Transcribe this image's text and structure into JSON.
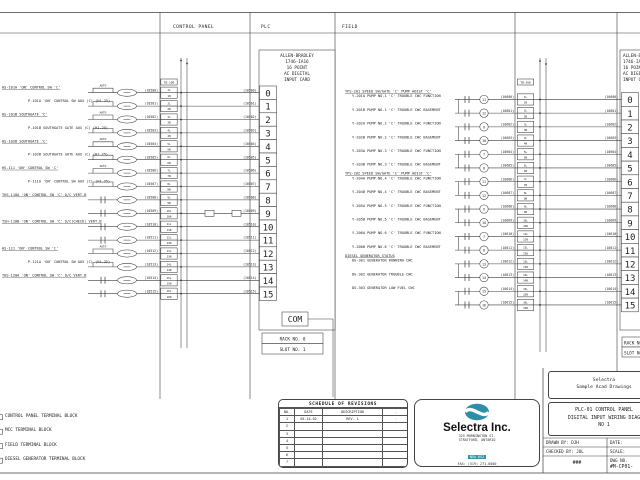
{
  "headers": {
    "control_panel": "CONTROL PANEL",
    "plc": "PLC",
    "field": "FIELD"
  },
  "left_card": {
    "title_lines": [
      "ALLEN-BRADLEY",
      "1746-IA16",
      "16 POINT",
      "AC DIGITAL",
      "INPUT CARD"
    ],
    "points": [
      "0",
      "1",
      "2",
      "3",
      "4",
      "5",
      "6",
      "7",
      "8",
      "9",
      "10",
      "11",
      "12",
      "13",
      "14",
      "15"
    ],
    "com": "COM",
    "rack": "RACK NO. 0",
    "slot": "SLOT NO. 1",
    "tb": "TB-100"
  },
  "right_card": {
    "title_lines": [
      "ALLEN-BRADLEY",
      "1746-IA16",
      "16 POINT",
      "AC DIGITAL",
      "INPUT CARD"
    ],
    "points": [
      "0",
      "1",
      "2",
      "3",
      "4",
      "5",
      "6",
      "7",
      "8",
      "9",
      "10",
      "11",
      "12",
      "13",
      "14",
      "15"
    ],
    "rack": "RACK NO. 0",
    "slot": "SLOT NO. 2",
    "tb": "TB-300"
  },
  "left_rows": [
    {
      "label": "HS-101A 'ON' CONTROL SW 'C'",
      "type": "main",
      "sym": "bracket",
      "auto": true,
      "wire": "10500",
      "tl": "1L",
      "tn": "1N"
    },
    {
      "label": "P-101A 'ON' CONTROL SW AUX (C) (H1.25)",
      "type": "sub",
      "sym": "bracket",
      "auto": false,
      "wire": "10501",
      "tl": "2L",
      "tn": "2N"
    },
    {
      "label": "HS-101B SOUTHGATE 'C'",
      "type": "main",
      "sym": "bracket",
      "auto": true,
      "wire": "10502",
      "tl": "3L",
      "tn": "3N"
    },
    {
      "label": "P-101B SOUTHGATE GATE AUX (C) (H1.25)",
      "type": "sub",
      "sym": "bracket",
      "auto": false,
      "wire": "10503",
      "tl": "4L",
      "tn": "4N"
    },
    {
      "label": "HS-102B SOUTHGATE 'C'",
      "type": "main",
      "sym": "bracket",
      "auto": true,
      "wire": "10504",
      "tl": "5L",
      "tn": "5N"
    },
    {
      "label": "P-102B SOUTHGATE GATE AUX (C) (H1.25)",
      "type": "sub",
      "sym": "bracket",
      "auto": false,
      "wire": "10505",
      "tl": "6L",
      "tn": "6N"
    },
    {
      "label": "HS-111 'ON' CONTROL SW 'C'",
      "type": "main",
      "sym": "bracket",
      "auto": true,
      "wire": "10506",
      "tl": "7L",
      "tn": "7N"
    },
    {
      "label": "P-111A 'ON' CONTROL SW AUX (C) (H1.25)",
      "type": "sub",
      "sym": "bracket",
      "auto": false,
      "wire": "10507",
      "tl": "8L",
      "tn": "8N"
    },
    {
      "label": "THS-110A 'ON' CONTROL SW 'C' O/C VERT.B",
      "type": "main",
      "sym": "contact",
      "auto": false,
      "wire": "10508",
      "tl": "9L",
      "tn": "9N"
    },
    {
      "label": "",
      "type": "sub",
      "sym": "contact",
      "auto": false,
      "wire": "10509",
      "tl": "10L",
      "tn": "10N"
    },
    {
      "label": "TSH-110B 'ON' CONTROL SW 'C' O/C(CHECK) VERT.B",
      "type": "main",
      "sym": "contact",
      "auto": false,
      "wire": "10510",
      "tl": "11L",
      "tn": "11N"
    },
    {
      "label": "",
      "type": "sub",
      "sym": "contact",
      "auto": false,
      "wire": "10511",
      "tl": "12L",
      "tn": "12N"
    },
    {
      "label": "HS-121 'ON' CONTROL SW 'C'",
      "type": "main",
      "sym": "bracket",
      "auto": true,
      "wire": "10512",
      "tl": "13L",
      "tn": "13N"
    },
    {
      "label": "P-121A 'ON' CONTROL SW AUX (C) (H1.25)",
      "type": "sub",
      "sym": "bracket",
      "auto": false,
      "wire": "10513",
      "tl": "14L",
      "tn": "14N"
    },
    {
      "label": "THS-120A 'ON' CONTROL SW 'C' O/C VERT.B",
      "type": "main",
      "sym": "contact",
      "auto": false,
      "wire": "10514",
      "tl": "15L",
      "tn": "15N"
    },
    {
      "label": "",
      "type": "sub",
      "sym": "contact",
      "auto": false,
      "wire": "10515",
      "tl": "16L",
      "tn": "16N"
    }
  ],
  "right_rows": [
    {
      "heading": "YPS-201 SPEED SW/GATE 'C' PUMP HOIST 'C'",
      "label": "Y-201A PUMP NO.1 'C' TROUBLE CWC FUNCTION",
      "circle": "11",
      "wire": "10600",
      "tl": "1L",
      "tn": "1N"
    },
    {
      "heading": "",
      "label": "Y-201B PUMP NO.1 'C' TROUBLE CWC BASEMENT",
      "circle": "12",
      "wire": "10601",
      "tl": "2L",
      "tn": "2N"
    },
    {
      "heading": "",
      "label": "Y-202A PUMP NO.2 'C' TROUBLE CWC FUNCTION",
      "circle": "9",
      "wire": "10602",
      "tl": "3L",
      "tn": "3N"
    },
    {
      "heading": "",
      "label": "Y-202B PUMP NO.2 'C' TROUBLE CWC BASEMENT",
      "circle": "10",
      "wire": "10603",
      "tl": "4L",
      "tn": "4N"
    },
    {
      "heading": "",
      "label": "Y-203A PUMP NO.3 'C' TROUBLE CWC FUNCTION",
      "circle": "7",
      "wire": "10604",
      "tl": "5L",
      "tn": "5N"
    },
    {
      "heading": "",
      "label": "Y-203B PUMP NO.3 'C' TROUBLE CWC BASEMENT",
      "circle": "8",
      "wire": "10605",
      "tl": "6L",
      "tn": "6N"
    },
    {
      "heading": "YPS-202 SPEED SW/GATE 'C' PUMP HOIST 'C'",
      "label": "Y-204A PUMP NO.4 'C' TROUBLE CWC FUNCTION",
      "circle": "11",
      "wire": "10606",
      "tl": "7L",
      "tn": "7N"
    },
    {
      "heading": "",
      "label": "Y-204B PUMP NO.4 'C' TROUBLE CWC BASEMENT",
      "circle": "12",
      "wire": "10607",
      "tl": "8L",
      "tn": "8N"
    },
    {
      "heading": "",
      "label": "Y-205A PUMP NO.5 'C' TROUBLE CWC FUNCTION",
      "circle": "9",
      "wire": "10608",
      "tl": "9L",
      "tn": "9N"
    },
    {
      "heading": "",
      "label": "Y-205B PUMP NO.5 'C' TROUBLE CWC BASEMENT",
      "circle": "10",
      "wire": "10609",
      "tl": "10L",
      "tn": "10N"
    },
    {
      "heading": "",
      "label": "Y-206A PUMP NO.6 'C' TROUBLE CWC FUNCTION",
      "circle": "7",
      "wire": "10610",
      "tl": "11L",
      "tn": "11N"
    },
    {
      "heading": "",
      "label": "Y-206B PUMP NO.6 'C' TROUBLE CWC BASEMENT",
      "circle": "8",
      "wire": "10611",
      "tl": "12L",
      "tn": "12N"
    },
    {
      "heading": "DIESEL GENERATOR STATUS",
      "label": "DG-301 GENERATOR RUNNING CWC",
      "circle": "13",
      "wire": "10612",
      "tl": "13L",
      "tn": "13N"
    },
    {
      "heading": "",
      "label": "DG-302 GENERATOR TROUBLE CWC",
      "circle": "14",
      "wire": "10613",
      "tl": "14L",
      "tn": "14N"
    },
    {
      "heading": "",
      "label": "DG-303 GENERATOR LOW FUEL CWC",
      "circle": "15",
      "wire": "10614",
      "tl": "15L",
      "tn": "15N"
    },
    {
      "heading": "",
      "label": "",
      "circle": "16",
      "wire": "10615",
      "tl": "16L",
      "tn": "16N"
    }
  ],
  "notes": [
    "CONTROL PANEL TERMINAL BLOCK",
    "MCC TERMINAL BLOCK",
    "FIELD  TERMINAL BLOCK",
    "DIESEL GENERATOR  TERMINAL BLOCK"
  ],
  "revisions": {
    "title": "SCHEDULE OF REVISIONS",
    "headers": [
      "NO.",
      "DATE",
      "DESCRIPTION",
      "-"
    ],
    "rows": [
      [
        "1",
        "05.14.02",
        "REV. 1",
        "-"
      ],
      [
        "2",
        "",
        "",
        ""
      ],
      [
        "3",
        "",
        "",
        ""
      ],
      [
        "4",
        "",
        "",
        ""
      ],
      [
        "5",
        "",
        "",
        ""
      ],
      [
        "6",
        "",
        "",
        ""
      ],
      [
        "7",
        "",
        "",
        ""
      ]
    ]
  },
  "company": {
    "name": "Selectra Inc.",
    "address": [
      "325 MORNINGTON ST.",
      "STRATFORD, ONTARIO",
      "N5A 6S2",
      "FAX: (519) 271-0500",
      "PHONE: (519) 271-0500"
    ],
    "logo_color": "#2d8fa6"
  },
  "titleblock": {
    "client_line1": "Selectra",
    "client_line2": "Sample Acad Drawings",
    "title_line1": "PLC-01 CONTROL PANEL",
    "title_line2": "DIGITAL INPUT WIRING DIAG",
    "title_line3": "NO 1",
    "drawn_by": "DRAWN BY: DJH",
    "date": "DATE:",
    "checked_by": "CHECKED BY: JOL",
    "scale": "SCALE:",
    "sheet": "###",
    "dwg_no_label": "DWG NO.",
    "dwg_no": "#M-CP01-"
  }
}
